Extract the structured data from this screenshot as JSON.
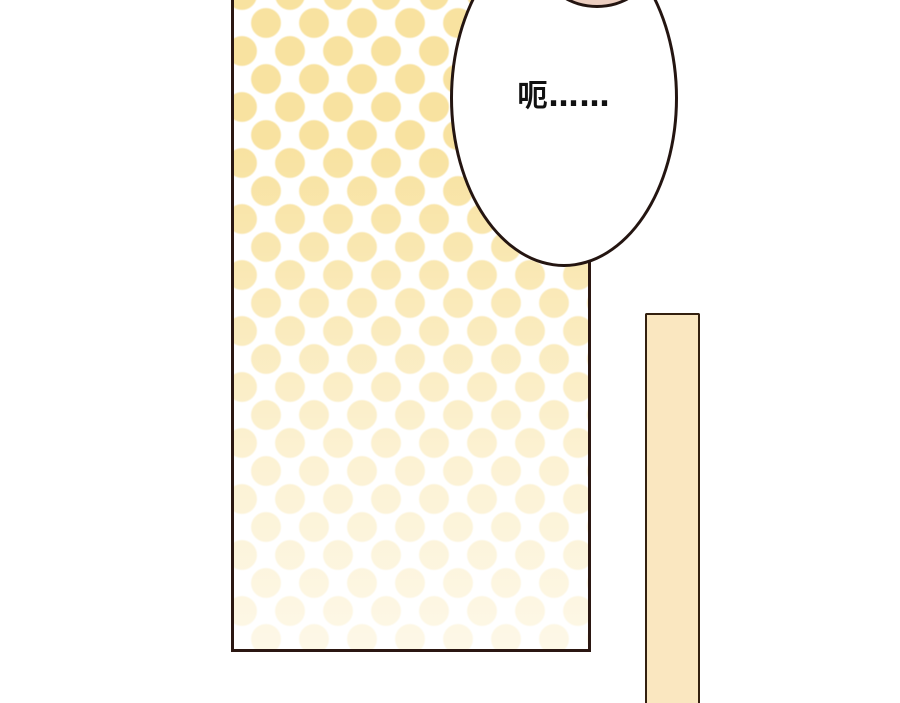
{
  "panel": {
    "background_color": "#ffffff",
    "speech_bubble": {
      "text": "呃……",
      "fill": "#ffffff",
      "outline_color": "#241511",
      "text_color": "#111111"
    },
    "polka_panel": {
      "dot_color": "#f8e2a0",
      "background": "#ffffff",
      "outline_color": "#2b1712",
      "fade_direction": "bottom"
    },
    "character_head": {
      "fill": "#eccec0",
      "outline_color": "#241511"
    },
    "vertical_bar": {
      "fill": "#fae7c0",
      "outline_color": "#33200f"
    }
  }
}
